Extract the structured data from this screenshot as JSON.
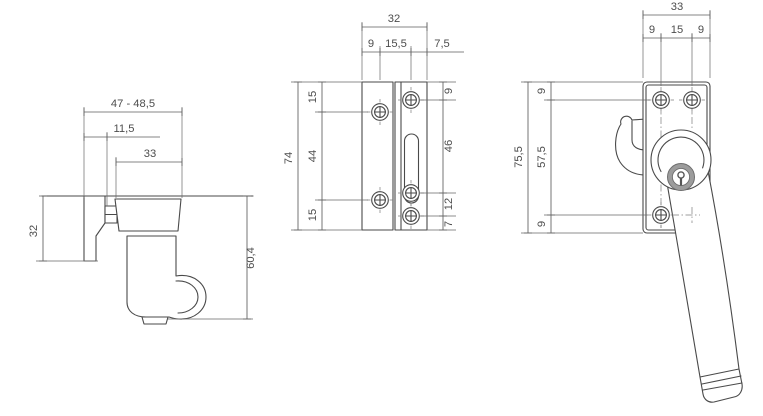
{
  "drawing": {
    "kind": "technical-drawing-window-fastener",
    "unit_style": "decimal-comma",
    "colors": {
      "line": "#4a4a4a",
      "dimension_line": "#5f5f5f",
      "text": "#4d4d4d",
      "cylinder_ring": "#9c9c9c",
      "background": "#ffffff"
    },
    "side_view": {
      "overall_depth": "47 - 48,5",
      "backset": "11,5",
      "handle_depth": "33",
      "plate_height": "32",
      "handle_length": "60,4"
    },
    "plate_view": {
      "plate_width": "32",
      "top_segments": [
        "9",
        "15,5",
        "7,5"
      ],
      "overall_height": "74",
      "left_segments": [
        "15",
        "44",
        "15"
      ],
      "right_segments": [
        "9",
        "46",
        "12",
        "7"
      ]
    },
    "front_view": {
      "plate_width": "33",
      "top_segments": [
        "9",
        "15",
        "9"
      ],
      "overall_height": "75,5",
      "left_segments": [
        "9",
        "57,5",
        "9"
      ]
    }
  }
}
